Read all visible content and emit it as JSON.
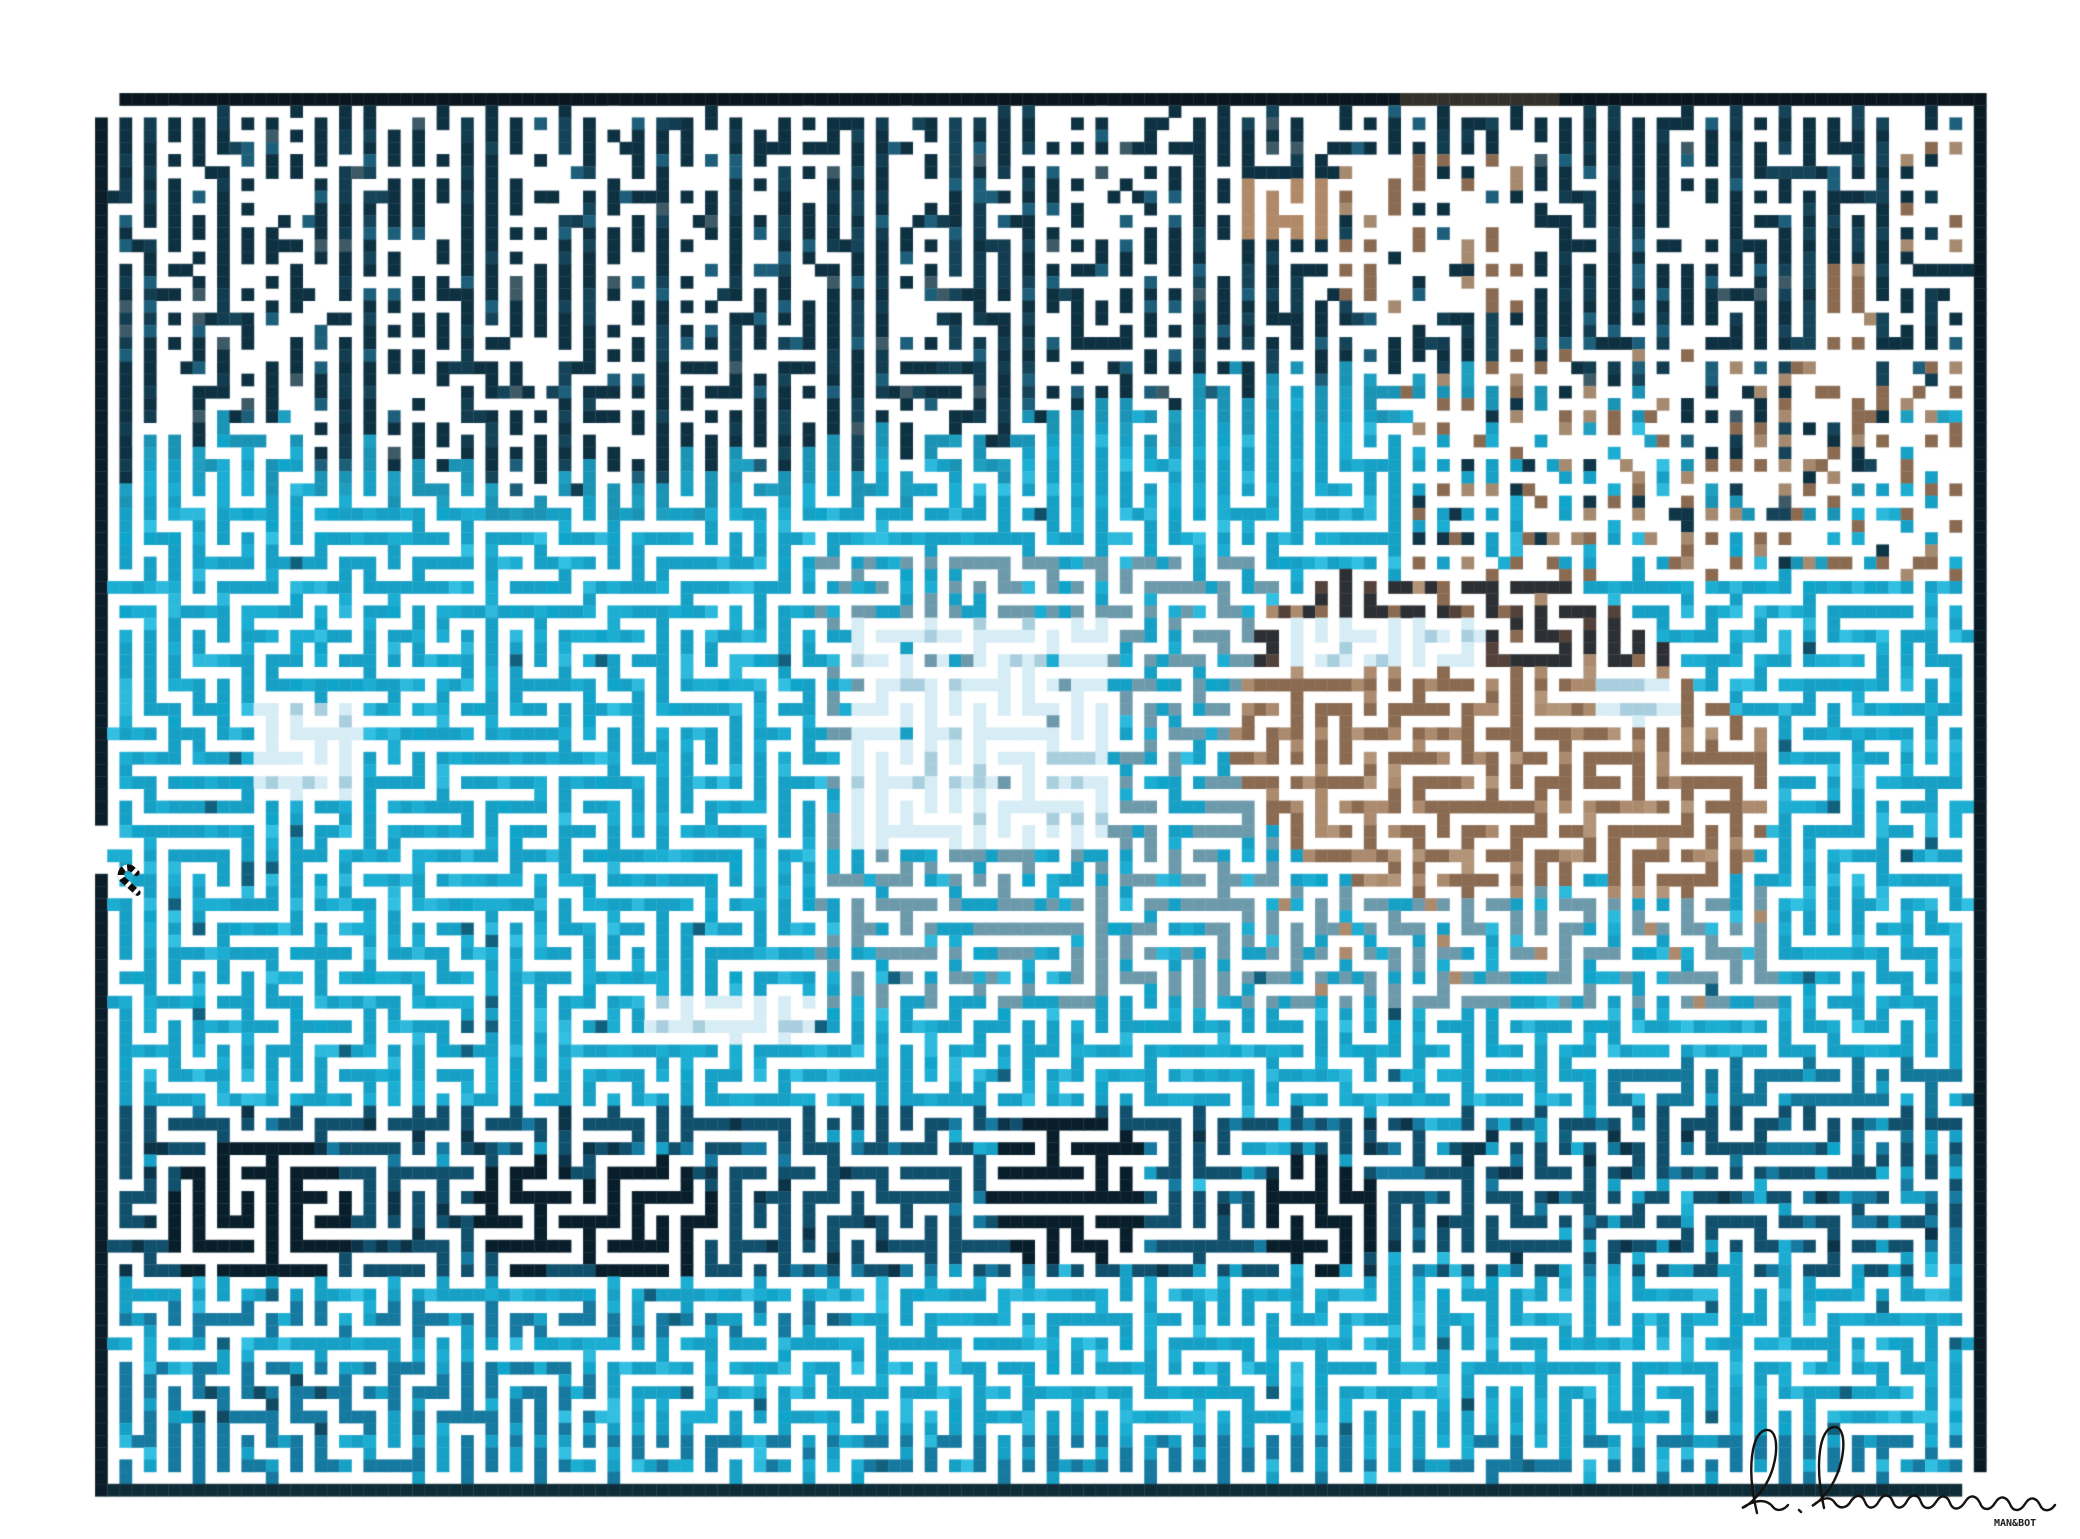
{
  "artwork": {
    "kind": "maze-art",
    "subject": "pixelated swimming-pool scene with brown figure rendered as a maze",
    "watermark": "MAN&BOT",
    "signature_script": "R. Rimmerum",
    "canvas": {
      "width": 2080,
      "height": 1539
    },
    "maze": {
      "left": 95,
      "top": 93,
      "cell": 12.2,
      "imgCols": 155,
      "imgRows": 115,
      "cols": 77,
      "rows": 57,
      "seed": 73114,
      "start": [
        0,
        31
      ],
      "vbias_top_v": 0.3,
      "vbias_w": 7,
      "edge_w": 4
    },
    "palette": {
      "white": "#ffffff",
      "border_top": [
        "#0a161e",
        "#0c1c26"
      ],
      "border_left": [
        "#0a1d28",
        "#081821"
      ],
      "border_right": [
        "#081a23",
        "#0b2430"
      ],
      "border_bottom": [
        "#0e2c38",
        "#0b2632"
      ],
      "border_brown": "#33302a",
      "band_cols": [
        "#154459",
        "#123c50",
        "#17485f",
        "#104052"
      ],
      "band_dark": "#0e3142",
      "band_light": "#1d5f7a",
      "band_gray": "#3e5a66",
      "transition": [
        "#1a93b5",
        "#1e9fc0"
      ],
      "cyan": "#1badd2",
      "cyan_jitter": [
        "#17a0c5",
        "#2cb9dc",
        "#0fa5cb",
        "#31bfe2"
      ],
      "cyan_speck": "#11617e",
      "cyan_speck_dark": "#0f4f68",
      "pale": "#a9cfde",
      "pale_bright": "#d7edf5",
      "gray_blue": "#6d9aab",
      "tan": "#9b7b60",
      "tan_vars": [
        "#8a6a50",
        "#ab8a6e",
        "#b29478"
      ],
      "brown_dark": "#53423a",
      "brown_black": "#2c2f33",
      "blob_gray": "#6b7a80",
      "dark_navy": "#0f3547",
      "top_tan": "#b08968",
      "top_gray": "#5a6a6a",
      "top_brown": [
        "#8a6b52",
        "#a58a70",
        "#7a5f4a"
      ],
      "streak_dark": "#11506c",
      "streak_darker": "#0b3449",
      "streak_black": "#081f2b",
      "streak_mid": "#1579a0",
      "streak_mid2": "#13779a",
      "deep_mid": "#0f4a62",
      "signature_ink": "#15120f",
      "seam": "rgba(255,255,255,0.10)"
    },
    "regions": {
      "band_keypoints": [
        [
          0,
          540
        ],
        [
          0.06,
          480
        ],
        [
          0.14,
          520
        ],
        [
          0.25,
          545
        ],
        [
          0.35,
          520
        ],
        [
          0.45,
          505
        ],
        [
          0.52,
          480
        ],
        [
          0.62,
          440
        ],
        [
          0.72,
          425
        ],
        [
          0.82,
          460
        ],
        [
          0.9,
          600
        ],
        [
          0.96,
          480
        ],
        [
          1,
          430
        ]
      ],
      "band_jitter": 56,
      "transition_depth": 34,
      "top_row_brown_x": [
        1400,
        1560
      ],
      "top_browns": [
        {
          "rect": [
            1240,
            180,
            1332,
            238
          ],
          "p": 0.65,
          "kind": "tan"
        },
        {
          "rect": [
            1340,
            148,
            1530,
            312
          ],
          "p": 0.33,
          "kind": "brown"
        },
        {
          "rect": [
            1820,
            262,
            1882,
            425
          ],
          "p": 0.5,
          "kind": "brown"
        },
        {
          "rect": [
            1944,
            348,
            1986,
            545
          ],
          "p": 0.45,
          "kind": "brown"
        },
        {
          "rect": [
            1895,
            128,
            1986,
            252
          ],
          "p": 0.3,
          "kind": "brown"
        }
      ],
      "halo": {
        "rect": [
          1400,
          355,
          1986,
          585
        ],
        "p_brown": 0.05,
        "p_dark": 0.1
      },
      "blob_ellipses": [
        [
          1465,
          735,
          235,
          165
        ],
        [
          1365,
          648,
          115,
          75
        ],
        [
          1665,
          792,
          115,
          105
        ]
      ],
      "blob_top_y": 665,
      "pale_rects": [
        {
          "rect": [
            850,
            615,
            1105,
            855
          ],
          "p": 0.45,
          "bars": [
            [
              695,
              715
            ],
            [
              737,
              757
            ],
            [
              788,
              808
            ],
            [
              828,
              845
            ]
          ],
          "p_bar": 0.85
        },
        {
          "rect": [
            1285,
            622,
            1480,
            668
          ],
          "p": 0.7,
          "bars": [],
          "p_bar": 0
        },
        {
          "rect": [
            1600,
            680,
            1680,
            725
          ],
          "p": 0.5,
          "bars": [],
          "p_bar": 0
        },
        {
          "rect": [
            250,
            698,
            368,
            800
          ],
          "p": 0.55,
          "bars": [
            [
              730,
              765
            ]
          ],
          "p_bar": 0.6
        },
        {
          "rect": [
            640,
            995,
            812,
            1050
          ],
          "p": 0.5,
          "bars": [
            [
              1005,
              1025
            ]
          ],
          "p_bar": 0.7
        }
      ],
      "gray_zones": [
        {
          "rect": [
            820,
            560,
            1280,
            1010
          ],
          "p": 0.07,
          "p_tan": 0
        },
        {
          "rect": [
            1250,
            880,
            1780,
            1010
          ],
          "p": 0.08,
          "p_tan": 0.05
        }
      ],
      "streak_rows": [
        {
          "y0": 1106,
          "y1": 1136,
          "pl": 0.45,
          "pr": 0.2
        },
        {
          "y0": 1136,
          "y1": 1164,
          "pl": 0.25,
          "pr": 0.12
        },
        {
          "y0": 1164,
          "y1": 1196,
          "pl": 0.5,
          "pr": 0.25
        },
        {
          "y0": 1196,
          "y1": 1250,
          "pl": 0.8,
          "pr": 0.4
        },
        {
          "y0": 1250,
          "y1": 1272,
          "pl": 0.35,
          "pr": 0.15
        }
      ],
      "streak_clusters": [
        [
          260,
          1222,
          90
        ],
        [
          530,
          1212,
          60
        ],
        [
          645,
          1218,
          70
        ],
        [
          1070,
          1190,
          80
        ],
        [
          1320,
          1215,
          60
        ]
      ],
      "right_band": {
        "rect": [
          1600,
          1055,
          1986,
          1175
        ],
        "p": 0.35
      },
      "secondary_streaks": [
        {
          "rect": [
            95,
            1295,
            850,
            1340
          ],
          "p": 0.18
        },
        {
          "rect": [
            95,
            1365,
            600,
            1432
          ],
          "p": 0.22
        }
      ],
      "dark_patch": {
        "rect": [
          200,
          1375,
          340,
          1430
        ],
        "p": 0.5
      },
      "bottom_fade": {
        "rect": [
          95,
          1430,
          1986,
          1484
        ],
        "p": 0.12
      },
      "openings": [
        [
          0,
          0
        ],
        [
          1,
          0
        ],
        [
          0,
          1
        ],
        [
          154,
          114
        ],
        [
          153,
          114
        ],
        [
          154,
          113
        ],
        [
          0,
          60
        ],
        [
          0,
          61
        ],
        [
          0,
          62
        ],
        [
          0,
          63
        ],
        [
          38,
          5
        ],
        [
          38,
          6
        ],
        [
          38,
          7
        ],
        [
          38,
          8
        ]
      ]
    }
  }
}
